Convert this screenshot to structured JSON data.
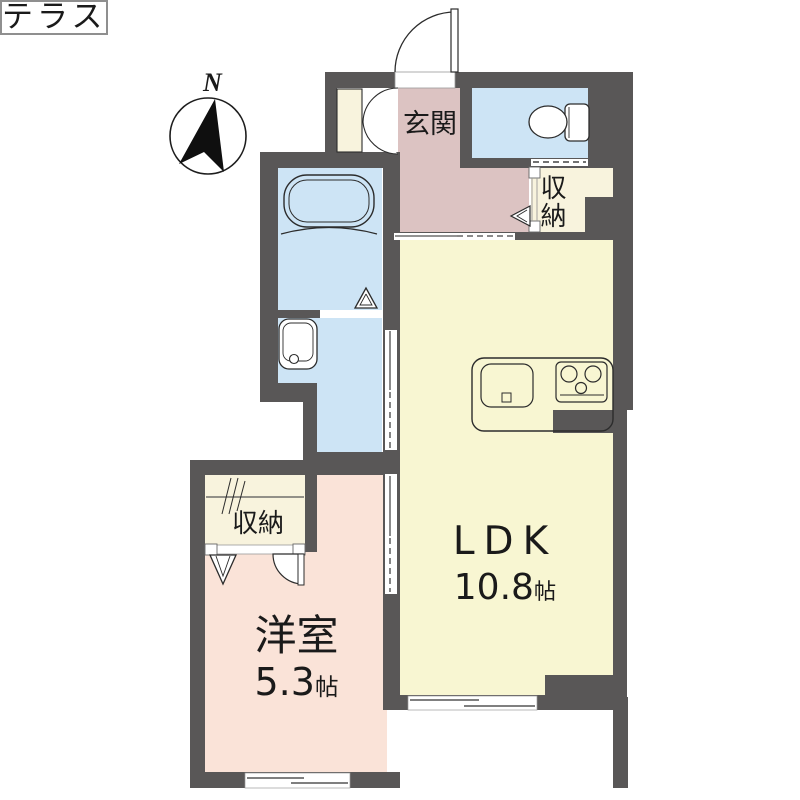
{
  "compass": {
    "label": "N"
  },
  "rooms": {
    "genkan": {
      "label": "玄関"
    },
    "storage_top": {
      "label": "収納"
    },
    "storage_bottom": {
      "label": "収納"
    },
    "ldk": {
      "label": "LDK",
      "size_value": "10.8",
      "size_unit": "帖"
    },
    "western": {
      "label": "洋室",
      "size_value": "5.3",
      "size_unit": "帖"
    },
    "terrace": {
      "label": "テラス"
    }
  },
  "fixtures": {
    "toilet": "toilet-icon",
    "bathtub": "bathtub-icon",
    "washbasin": "washbasin-icon",
    "kitchen_sink": "kitchen-sink-icon",
    "stove": "stove-icon",
    "hanger_pipe": "hanger-pipe-icon",
    "compass": "compass-icon"
  },
  "colors": {
    "wall": "#595757",
    "ldk": "#f8f6d2",
    "hall": "#dcc3c2",
    "water": "#cde4f5",
    "western": "#fae3d8",
    "closet": "#f8f3dd"
  }
}
